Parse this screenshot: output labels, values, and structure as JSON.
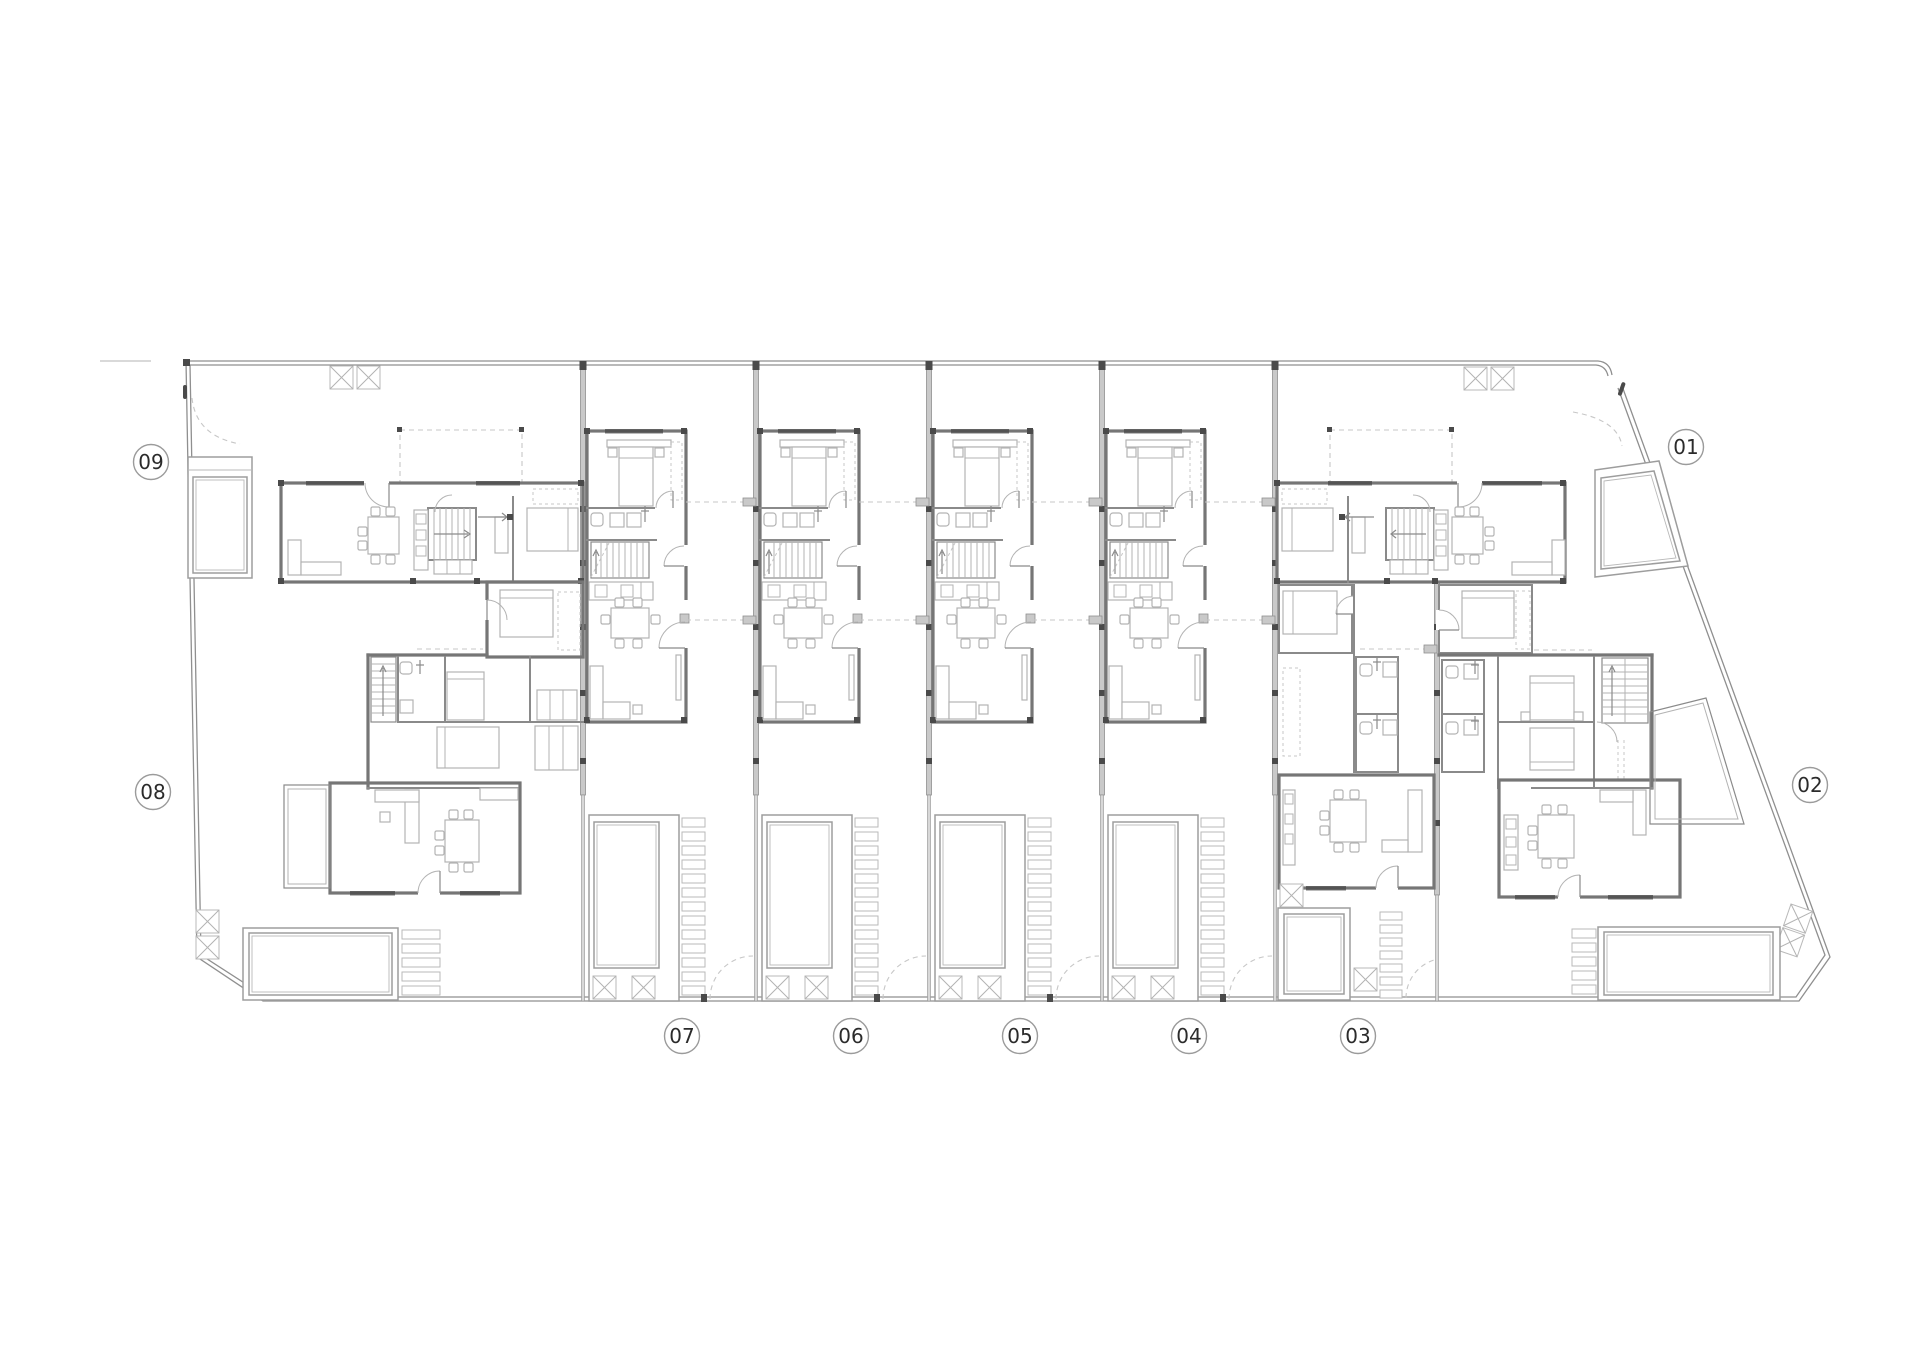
{
  "plan": {
    "type": "residential row-housing ground floor site plan",
    "background": "#ffffff",
    "units_total": 9
  },
  "colors": {
    "wall": "#767676",
    "wall2": "#8a8a8a",
    "furn": "#b3b3b3",
    "dash": "#c7c7c7",
    "pwfill": "#c9c9c9",
    "pwedge": "#909090",
    "dark": "#4a4a4a",
    "bnd": "#8f8f8f",
    "pool": "#9d9d9d",
    "lblstroke": "#9b9b9b",
    "lbltext": "#2b2b2b"
  },
  "units": {
    "labels": [
      {
        "id": "01",
        "x": 1686,
        "y": 447
      },
      {
        "id": "02",
        "x": 1810,
        "y": 785
      },
      {
        "id": "03",
        "x": 1358,
        "y": 1036
      },
      {
        "id": "04",
        "x": 1189,
        "y": 1036
      },
      {
        "id": "05",
        "x": 1020,
        "y": 1036
      },
      {
        "id": "06",
        "x": 851,
        "y": 1036
      },
      {
        "id": "07",
        "x": 682,
        "y": 1036
      },
      {
        "id": "08",
        "x": 153,
        "y": 792
      },
      {
        "id": "09",
        "x": 151,
        "y": 462
      }
    ],
    "middle": {
      "ids": [
        "07",
        "06",
        "05",
        "04"
      ],
      "origins": [
        583,
        756,
        929,
        1102
      ]
    },
    "left_end": [
      "09",
      "08"
    ],
    "right_end": [
      "01",
      "02",
      "03"
    ]
  },
  "party_walls": {
    "x": [
      583,
      756,
      929,
      1102,
      1275
    ],
    "thick_y": [
      363,
      795
    ],
    "thin_y": [
      795,
      1001
    ],
    "pilaster_y": [
      506,
      560,
      624,
      690,
      758
    ]
  }
}
